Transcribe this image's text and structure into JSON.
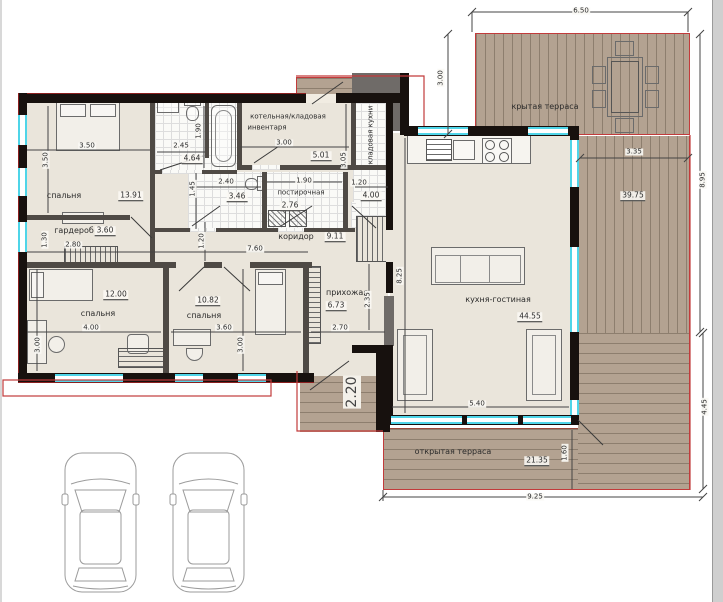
{
  "drawing": {
    "type": "floor-plan",
    "parked_cars": 2
  },
  "colors": {
    "deck": "#b3a291",
    "deck_line": "#8d7e6e",
    "wall": "#17110e",
    "interior_wall": "#4f4a45",
    "window": "#4fd5e8",
    "roof_outline": "#c23b3b",
    "floor": "#eae5db",
    "text": "#2b2b2b"
  },
  "rooms": {
    "bedroom1": {
      "name": "спальня",
      "area": "13.91",
      "width": "3.50",
      "height": "3.50"
    },
    "wardrobe": {
      "name": "гардероб",
      "area": "3.60",
      "width": "2.80",
      "height": "1.30"
    },
    "bathroom": {
      "area": "4.64",
      "width": "2.45",
      "height": "1.90"
    },
    "wc": {
      "area": "3.46",
      "width": "2.40",
      "height": "1.45"
    },
    "boiler": {
      "name_line1": "котельная/кладовая",
      "name_line2": "инвентаря",
      "area": "5.01",
      "width": "3.00",
      "height": "3.05"
    },
    "pantry": {
      "name": "кладовая кухни",
      "area": "4.00",
      "width": "1.20"
    },
    "laundry": {
      "name": "постирочная",
      "area": "2.76",
      "width": "1.90"
    },
    "corridor": {
      "name": "коридор",
      "area": "9.11",
      "width": "7.60",
      "height": "1.20"
    },
    "bedroom2": {
      "name": "спальня",
      "area": "12.00",
      "width": "4.00",
      "height": "3.00"
    },
    "bedroom3": {
      "name": "спальня",
      "area": "10.82",
      "width": "3.60",
      "height": "3.00"
    },
    "hallway": {
      "name": "прихожая",
      "area": "6.73",
      "width": "2.70",
      "height": "2.35"
    },
    "kitchen_living": {
      "name": "кухня-гостиная",
      "area": "44.55",
      "width": "5.40",
      "height": "8.25"
    },
    "covered_terrace": {
      "name": "крытая терраса",
      "width": "6.50",
      "height": "3.00"
    },
    "side_terrace": {
      "area": "39.75",
      "width": "3.35",
      "height": "8.95",
      "lower_height": "4.45"
    },
    "open_terrace": {
      "name": "открытая терраса",
      "area": "21.35",
      "width": "9.25",
      "height": "1.60"
    },
    "entry_porch": {
      "width": "2.20"
    }
  }
}
